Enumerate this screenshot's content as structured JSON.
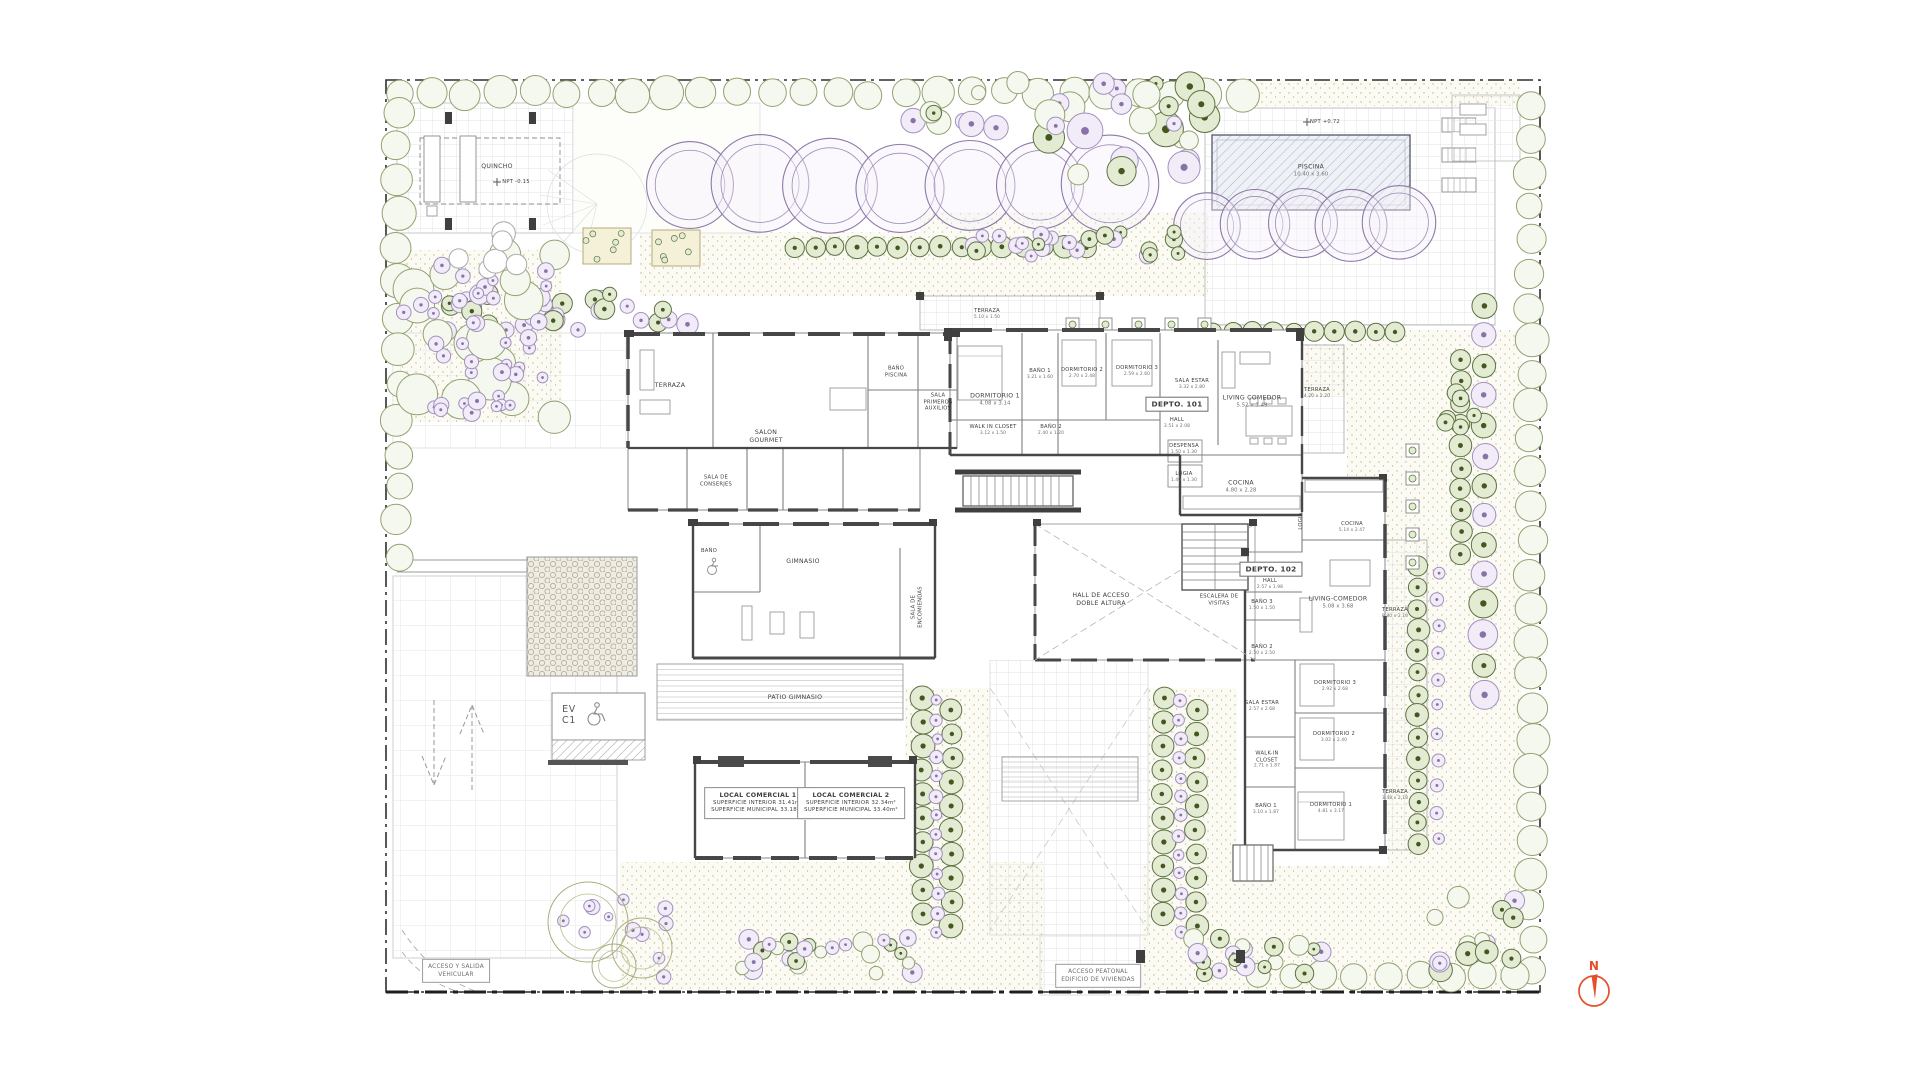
{
  "colors": {
    "north_accent": "#e4502a",
    "wall": "#4a4a4a",
    "purple_tree": "#8d79a8",
    "hedge_green": "#5d7342",
    "lavender": "#a390bf"
  },
  "plan": {
    "labels": [
      {
        "id": "quincho",
        "cls": "sm",
        "x": 497,
        "y": 167,
        "lines": [
          "QUINCHO"
        ]
      },
      {
        "id": "quincho-level",
        "cls": "mi",
        "x": 516,
        "y": 182,
        "lines": [
          "NPT -0.15"
        ]
      },
      {
        "id": "piscina",
        "cls": "sm",
        "x": 1311,
        "y": 171,
        "lines": [
          "PISCINA",
          "10.40 x 3.60"
        ]
      },
      {
        "id": "pool-level",
        "cls": "mi",
        "x": 1325,
        "y": 122,
        "lines": [
          "NPT +0.72"
        ]
      },
      {
        "id": "terraza-top",
        "cls": "mi",
        "x": 987,
        "y": 314,
        "lines": [
          "TERRAZA",
          "5.10 x 1.50"
        ]
      },
      {
        "id": "terraza-wing",
        "cls": "sm",
        "x": 670,
        "y": 386,
        "lines": [
          "TERRAZA"
        ]
      },
      {
        "id": "salon-gourmet",
        "cls": "sm",
        "x": 766,
        "y": 437,
        "lines": [
          "SALON",
          "GOURMET"
        ]
      },
      {
        "id": "bano-piscina",
        "cls": "mi",
        "x": 896,
        "y": 372,
        "lines": [
          "BAÑO",
          "PISCINA"
        ]
      },
      {
        "id": "sala-primeros-auxilios",
        "cls": "mi",
        "x": 938,
        "y": 402,
        "lines": [
          "SALA",
          "PRIMEROS",
          "AUXILIOS"
        ]
      },
      {
        "id": "sala-de-conserjes",
        "cls": "mi",
        "x": 716,
        "y": 481,
        "lines": [
          "SALA DE",
          "CONSERJES"
        ]
      },
      {
        "id": "bano-gimnasio",
        "cls": "mi",
        "x": 709,
        "y": 551,
        "lines": [
          "BAÑO"
        ]
      },
      {
        "id": "gimnasio",
        "cls": "sm",
        "x": 803,
        "y": 562,
        "lines": [
          "GIMNASIO"
        ]
      },
      {
        "id": "sala-de-encomiendas",
        "cls": "vert mi",
        "x": 917,
        "y": 607,
        "lines": [
          "SALA DE",
          "ENCOMIENDAS"
        ]
      },
      {
        "id": "patio-gimnasio",
        "cls": "sm",
        "x": 795,
        "y": 698,
        "lines": [
          "PATIO GIMNASIO"
        ]
      },
      {
        "id": "hall-de-acceso",
        "cls": "sm",
        "x": 1101,
        "y": 600,
        "lines": [
          "HALL DE ACCESO",
          "DOBLE ALTURA"
        ]
      },
      {
        "id": "escalera-de-visitas",
        "cls": "mi",
        "x": 1219,
        "y": 600,
        "lines": [
          "ESCALERA DE",
          "VISITAS"
        ]
      },
      {
        "id": "depto-101",
        "cls": "bx",
        "x": 1177,
        "y": 404,
        "lines": [
          "DEPTO. 101"
        ]
      },
      {
        "id": "hall-101",
        "cls": "mi",
        "x": 1177,
        "y": 423,
        "lines": [
          "HALL",
          "3.51 x 2.08"
        ]
      },
      {
        "id": "dormitorio1-101",
        "cls": "sm",
        "x": 995,
        "y": 400,
        "lines": [
          "DORMITORIO 1",
          "4.08 x 3.14"
        ]
      },
      {
        "id": "bano1-101",
        "cls": "mi",
        "x": 1040,
        "y": 374,
        "lines": [
          "BAÑO 1",
          "3.21 x 1.60"
        ]
      },
      {
        "id": "dormitorio2-101",
        "cls": "mi",
        "x": 1082,
        "y": 373,
        "lines": [
          "DORMITORIO 2",
          "2.70 x 2.48"
        ]
      },
      {
        "id": "dormitorio3-101",
        "cls": "mi",
        "x": 1137,
        "y": 371,
        "lines": [
          "DORMITORIO 3",
          "2.59 x 2.60"
        ]
      },
      {
        "id": "sala-estar-101",
        "cls": "mi",
        "x": 1192,
        "y": 384,
        "lines": [
          "SALA ESTAR",
          "3.32 x 2.80"
        ]
      },
      {
        "id": "living-comedor-101",
        "cls": "sm",
        "x": 1252,
        "y": 402,
        "lines": [
          "LIVING COMEDOR",
          "5.52 x 3.49"
        ]
      },
      {
        "id": "walk-in-closet-101",
        "cls": "mi",
        "x": 993,
        "y": 430,
        "lines": [
          "WALK IN CLOSET",
          "3.12 x 1.50"
        ]
      },
      {
        "id": "bano2-101",
        "cls": "mi",
        "x": 1051,
        "y": 430,
        "lines": [
          "BAÑO 2",
          "2.40 x 1.20"
        ]
      },
      {
        "id": "despensa-101",
        "cls": "mi",
        "x": 1184,
        "y": 449,
        "lines": [
          "DESPENSA",
          "1.50 x 1.30"
        ]
      },
      {
        "id": "logia-101",
        "cls": "mi",
        "x": 1184,
        "y": 477,
        "lines": [
          "LOGIA",
          "1.40 x 1.30"
        ]
      },
      {
        "id": "cocina-101",
        "cls": "sm",
        "x": 1241,
        "y": 487,
        "lines": [
          "COCINA",
          "4.80 x 2.28"
        ]
      },
      {
        "id": "terraza-101-este",
        "cls": "mi",
        "x": 1317,
        "y": 393,
        "lines": [
          "TERRAZA",
          "4.20 x 2.20"
        ]
      },
      {
        "id": "depto-102",
        "cls": "bx",
        "x": 1271,
        "y": 569,
        "lines": [
          "DEPTO. 102"
        ]
      },
      {
        "id": "hall-102",
        "cls": "mi",
        "x": 1270,
        "y": 584,
        "lines": [
          "HALL",
          "2.57 x 1.98"
        ]
      },
      {
        "id": "bano3-102",
        "cls": "mi",
        "x": 1262,
        "y": 605,
        "lines": [
          "BAÑO 3",
          "1.50 x 1.50"
        ]
      },
      {
        "id": "bano2-102",
        "cls": "mi",
        "x": 1262,
        "y": 650,
        "lines": [
          "BAÑO 2",
          "2.50 x 2.50"
        ]
      },
      {
        "id": "living-comedor-102",
        "cls": "sm",
        "x": 1338,
        "y": 603,
        "lines": [
          "LIVING-COMEDOR",
          "5.08 x 3.68"
        ]
      },
      {
        "id": "terraza-102-este",
        "cls": "mi",
        "x": 1395,
        "y": 613,
        "lines": [
          "TERRAZA",
          "8.80 x 2.10"
        ]
      },
      {
        "id": "cocina-102",
        "cls": "mi",
        "x": 1352,
        "y": 527,
        "lines": [
          "COCINA",
          "5.14 x 2.47"
        ]
      },
      {
        "id": "logia-102",
        "cls": "vert mi",
        "x": 1301,
        "y": 521,
        "lines": [
          "LOGIA"
        ]
      },
      {
        "id": "dormitorio3-102",
        "cls": "mi",
        "x": 1335,
        "y": 686,
        "lines": [
          "DORMITORIO 3",
          "2.92 x 2.68"
        ]
      },
      {
        "id": "sala-estar-102",
        "cls": "mi",
        "x": 1262,
        "y": 706,
        "lines": [
          "SALA ESTAR",
          "2.57 x 2.68"
        ]
      },
      {
        "id": "dormitorio2-102",
        "cls": "mi",
        "x": 1334,
        "y": 737,
        "lines": [
          "DORMITORIO 2",
          "3.02 x 2.40"
        ]
      },
      {
        "id": "walk-in-closet-102",
        "cls": "mi",
        "x": 1267,
        "y": 760,
        "lines": [
          "WALK-IN",
          "CLOSET",
          "2.71 x 1.87"
        ]
      },
      {
        "id": "bano1-102",
        "cls": "mi",
        "x": 1266,
        "y": 809,
        "lines": [
          "BAÑO 1",
          "3.10 x 1.87"
        ]
      },
      {
        "id": "dormitorio1-102",
        "cls": "mi",
        "x": 1331,
        "y": 808,
        "lines": [
          "DORMITORIO 1",
          "4.81 x 3.17"
        ]
      },
      {
        "id": "terraza-102-sur",
        "cls": "mi",
        "x": 1395,
        "y": 795,
        "lines": [
          "TERRAZA",
          "3.48 x 2.18"
        ]
      },
      {
        "id": "local-comercial-1",
        "cls": "bx3",
        "x": 758,
        "y": 803,
        "lines": [
          "LOCAL COMERCIAL 1",
          "SUPERFICIE INTERIOR 31.41m²",
          "SUPERFICIE MUNICIPAL 33.18m²"
        ]
      },
      {
        "id": "local-comercial-2",
        "cls": "bx3",
        "x": 851,
        "y": 803,
        "lines": [
          "LOCAL COMERCIAL 2",
          "SUPERFICIE INTERIOR 32.34m²",
          "SUPERFICIE MUNICIPAL 33.40m²"
        ]
      },
      {
        "id": "ev-c1",
        "cls": "ev",
        "x": 569,
        "y": 716,
        "lines": [
          "EV",
          "C1"
        ]
      },
      {
        "id": "acceso-vehicular",
        "cls": "soft",
        "x": 456,
        "y": 971,
        "lines": [
          "ACCESO Y SALIDA",
          "VEHICULAR"
        ]
      },
      {
        "id": "acceso-peatonal",
        "cls": "soft",
        "x": 1098,
        "y": 976,
        "lines": [
          "ACCESO PEATONAL",
          "EDIFICIO DE VIVIENDAS"
        ]
      },
      {
        "id": "north-letter",
        "cls": "north",
        "x": 1594,
        "y": 967,
        "lines": [
          "N"
        ]
      }
    ]
  }
}
